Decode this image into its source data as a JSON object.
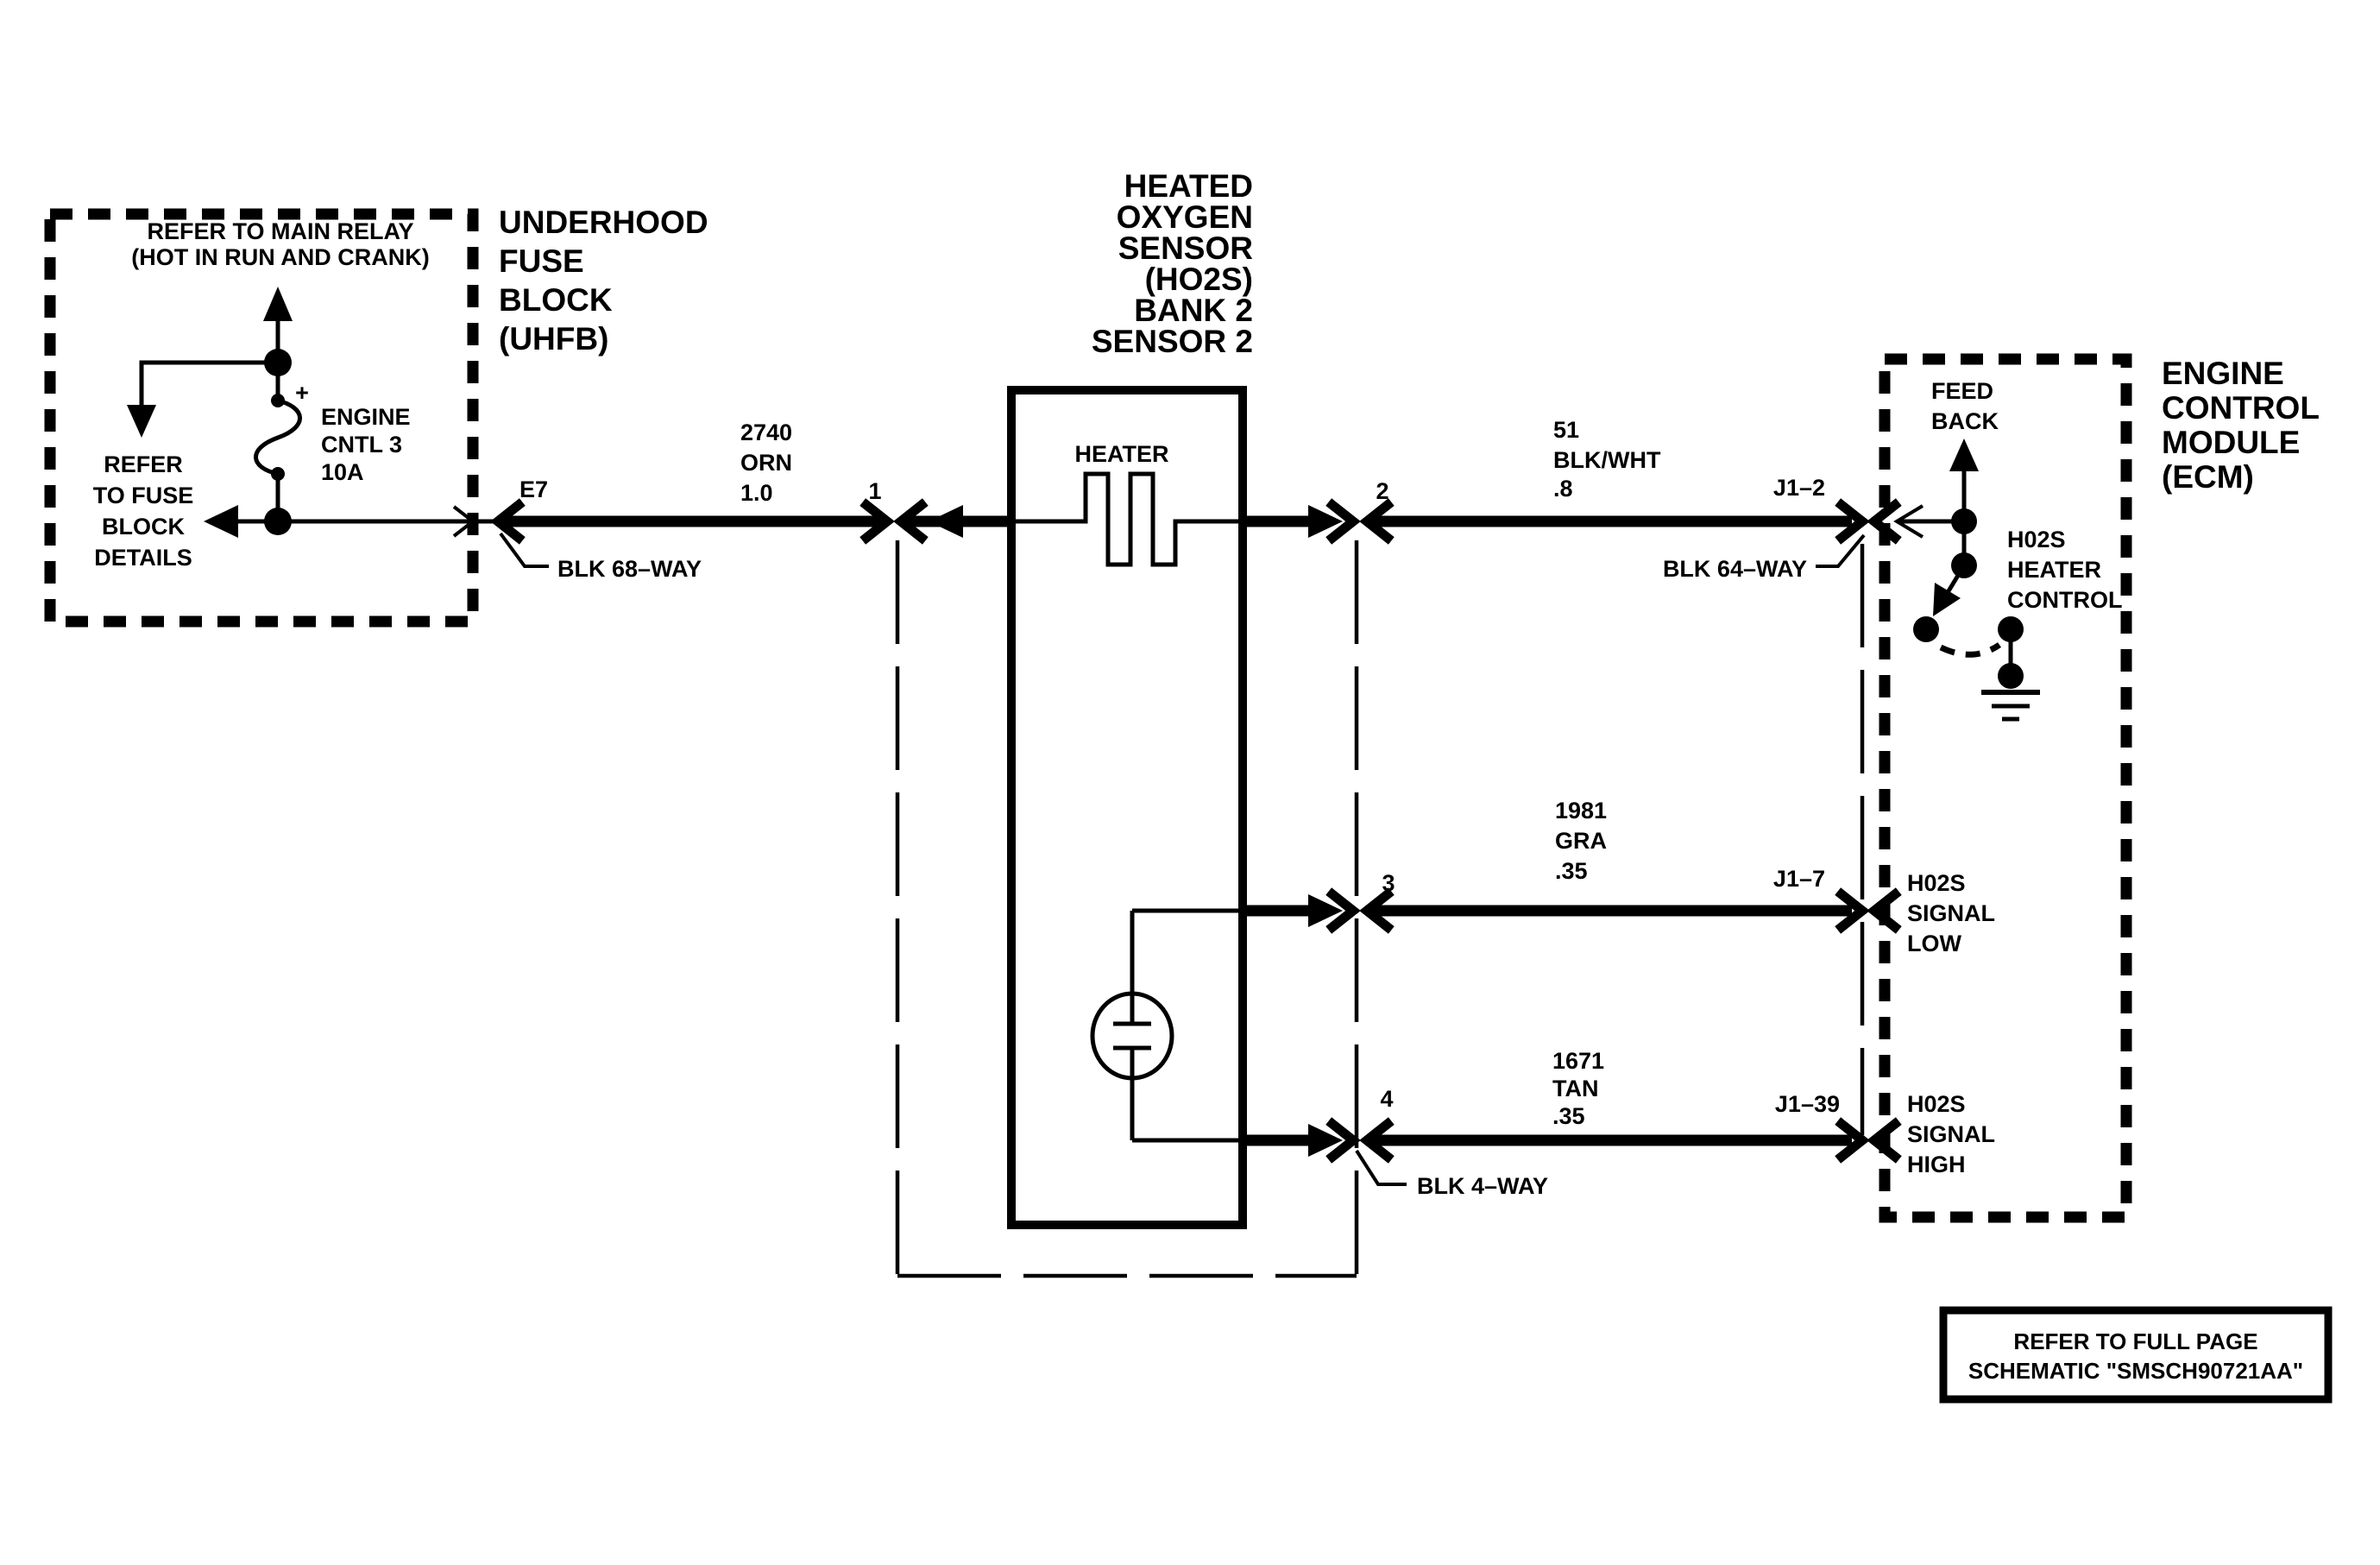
{
  "page": {
    "background": "#ffffff",
    "ink": "#000000"
  },
  "fuse_detail_box": {
    "title_line1": "REFER TO MAIN RELAY",
    "title_line2": "(HOT IN RUN AND CRANK)",
    "fuse_plus": "+",
    "fuse_name_line1": "ENGINE",
    "fuse_name_line2": "CNTL 3",
    "fuse_name_line3": "10A",
    "note_line1": "REFER",
    "note_line2": "TO FUSE",
    "note_line3": "BLOCK",
    "note_line4": "DETAILS"
  },
  "uhfb": {
    "title_line1": "UNDERHOOD",
    "title_line2": "FUSE",
    "title_line3": "BLOCK",
    "title_line4": "(UHFB)"
  },
  "sensor": {
    "title_line1": "HEATED",
    "title_line2": "OXYGEN",
    "title_line3": "SENSOR",
    "title_line4": "(HO2S)",
    "title_line5": "BANK 2",
    "title_line6": "SENSOR 2",
    "heater_label": "HEATER"
  },
  "ecm": {
    "title_line1": "ENGINE",
    "title_line2": "CONTROL",
    "title_line3": "MODULE",
    "title_line4": "(ECM)",
    "feedback_line1": "FEED",
    "feedback_line2": "BACK",
    "heater_control_line1": "H02S",
    "heater_control_line2": "HEATER",
    "heater_control_line3": "CONTROL",
    "signal_low_line1": "H02S",
    "signal_low_line2": "SIGNAL",
    "signal_low_line3": "LOW",
    "signal_high_line1": "H02S",
    "signal_high_line2": "SIGNAL",
    "signal_high_line3": "HIGH"
  },
  "wires": {
    "heater_feed": {
      "circuit": "2740",
      "color": "ORN",
      "gauge": "1.0",
      "pin_left": "E7",
      "pin_right": "1"
    },
    "heater_control": {
      "circuit": "51",
      "color": "BLK/WHT",
      "gauge": ".8",
      "pin_left": "2",
      "pin_right": "J1–2"
    },
    "signal_low": {
      "circuit": "1981",
      "color": "GRA",
      "gauge": ".35",
      "pin_left": "3",
      "pin_right": "J1–7"
    },
    "signal_high": {
      "circuit": "1671",
      "color": "TAN",
      "gauge": ".35",
      "pin_left": "4",
      "pin_right": "J1–39"
    }
  },
  "connectors": {
    "uhfb_connector": "BLK 68–WAY",
    "ecm_connector": "BLK 64–WAY",
    "sensor_connector": "BLK 4–WAY"
  },
  "note_box": {
    "line1": "REFER TO FULL PAGE",
    "line2": "SCHEMATIC \"SMSCH90721AA\""
  }
}
